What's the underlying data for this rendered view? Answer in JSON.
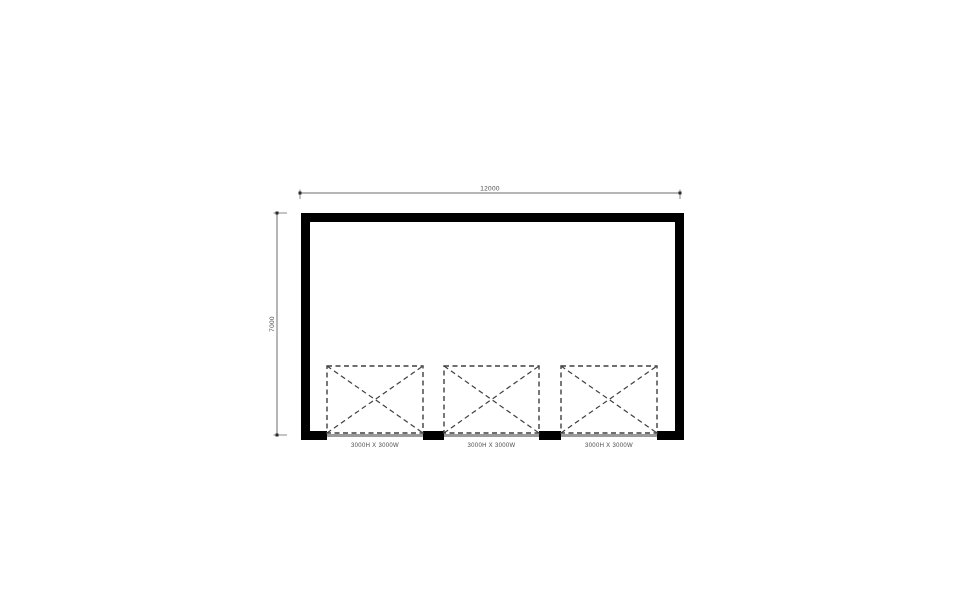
{
  "drawing": {
    "type": "floor-plan",
    "dimensions": {
      "width_label": "12000",
      "height_label": "7000"
    },
    "doors": [
      {
        "label": "3000H X 3000W"
      },
      {
        "label": "3000H X 3000W"
      },
      {
        "label": "3000H X 3000W"
      }
    ],
    "colors": {
      "wall": "#000000",
      "door_dash": "#3f3f3f",
      "dim_line": "#6e6e6e",
      "dim_text": "#4a4a4a",
      "threshold": "#9a9a9a",
      "background": "#ffffff"
    }
  }
}
